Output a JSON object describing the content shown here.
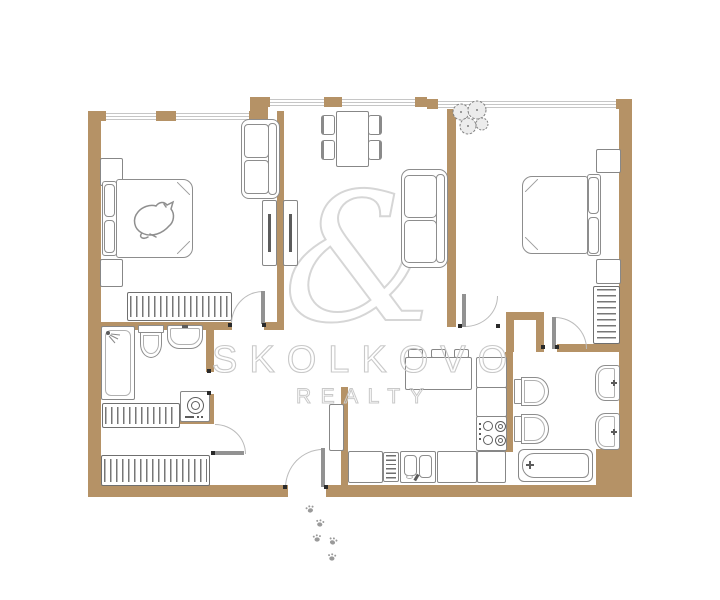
{
  "type": "floorplan",
  "watermark": {
    "brand": "SKOLKOVO",
    "tagline": "REALTY",
    "monogram": "&"
  },
  "palette": {
    "wall": "#b59266",
    "furniture_line": "#878787",
    "window_line": "#c6c6c6",
    "watermark_line": "#c9c9c9",
    "jamb": "#2a2a2a",
    "background": "#ffffff"
  },
  "rooms": [
    {
      "name": "bedroom-left",
      "fixtures": [
        "double-bed",
        "sleeping-cat",
        "nightstand",
        "nightstand",
        "sofa",
        "tv-unit",
        "wardrobe"
      ]
    },
    {
      "name": "living-dining",
      "fixtures": [
        "dining-table",
        "chair",
        "chair",
        "chair",
        "chair",
        "sofa",
        "tv-unit"
      ]
    },
    {
      "name": "bedroom-right",
      "fixtures": [
        "double-bed",
        "nightstand",
        "nightstand",
        "plant",
        "shelf-unit"
      ]
    },
    {
      "name": "bathroom-left",
      "fixtures": [
        "shower",
        "toilet",
        "sink",
        "washing-machine"
      ]
    },
    {
      "name": "hallway",
      "fixtures": [
        "wardrobe",
        "wardrobe",
        "cabinet",
        "entrance-door"
      ]
    },
    {
      "name": "kitchen",
      "fixtures": [
        "island-table",
        "stool",
        "stool",
        "stool",
        "stove",
        "double-sink",
        "dishwasher",
        "counter"
      ]
    },
    {
      "name": "bathroom-right",
      "fixtures": [
        "toilet",
        "toilet",
        "sink",
        "sink",
        "bathtub"
      ]
    }
  ],
  "decor": {
    "paw_prints": 5
  }
}
